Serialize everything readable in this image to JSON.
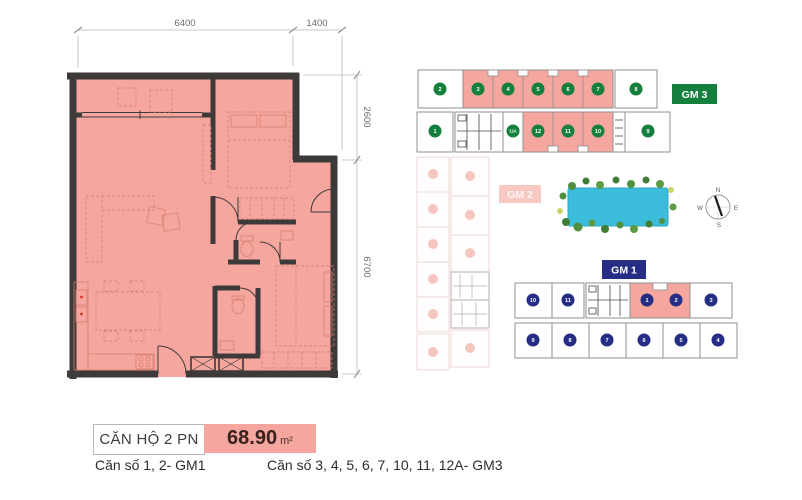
{
  "dims": {
    "top_width": "6400",
    "top_right": "1400",
    "right_upper": "2600",
    "right_lower": "6700"
  },
  "site": {
    "gm3": {
      "label": "GM 3",
      "top_units": [
        "2",
        "3",
        "4",
        "5",
        "6",
        "7",
        "8"
      ],
      "bottom_units": [
        "1",
        "12A",
        "12",
        "11",
        "10",
        "9"
      ]
    },
    "gm2": {
      "label": "GM 2"
    },
    "gm1": {
      "label": "GM 1",
      "top_units": [
        "10",
        "11",
        "1",
        "2",
        "3"
      ],
      "bottom_units": [
        "9",
        "8",
        "7",
        "6",
        "5",
        "4"
      ]
    },
    "compass": {
      "n": "N",
      "e": "E",
      "s": "S",
      "w": "W"
    }
  },
  "caption": {
    "type_label": "CĂN HỘ 2 PN",
    "area_value": "68.90",
    "area_unit": "m²",
    "gm1_note": "Căn số 1, 2- GM1",
    "gm3_note": "Căn số 3, 4, 5, 6, 7, 10, 11, 12A- GM3"
  },
  "colors": {
    "highlight_pink": "#f5a69e",
    "gm3_green": "#15803d",
    "gm1_navy": "#252e84",
    "pool_blue": "#3cbcdb",
    "wall_dark": "#3e3a39"
  }
}
